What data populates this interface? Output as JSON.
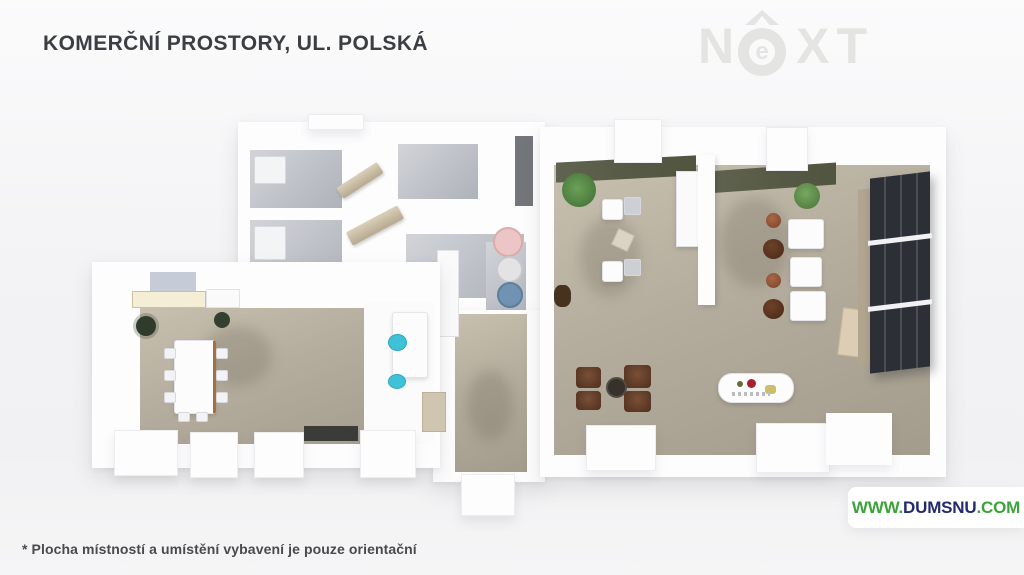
{
  "header": {
    "title": "KOMERČNÍ PROSTORY, UL. POLSKÁ"
  },
  "logo": {
    "letter_n": "N",
    "letter_e": "e",
    "letters_xt": "XT",
    "color": "#e4e4e2"
  },
  "watermark": {
    "www": "WWW.",
    "domain": "DUMSNU",
    "tld": ".COM",
    "green": "#3ba33a",
    "navy": "#232b6e"
  },
  "footer": {
    "disclaimer": "* Plocha místností a umístění vybavení je pouze orientační"
  },
  "palette": {
    "background": "#f3f3f5",
    "walls": "#fdfdfe",
    "wood_floor": "#b4ac9c",
    "tile_floor": "#bcc0c6",
    "wall_cap_olive": "#575b46",
    "door_beige": "#c9bca2",
    "kitchen_cream": "#f4eed7",
    "chair_teal": "#3fc2d8",
    "table_pink": "#ecc6c6",
    "table_blue": "#7093b3",
    "chair_terracotta": "#8a4f33",
    "chair_dark_brown": "#54301f",
    "shelving_charcoal": "#2c3036",
    "plant_green": "#4e7d42",
    "accent_red": "#a81f2f",
    "accent_yellow": "#cdbf6a"
  }
}
